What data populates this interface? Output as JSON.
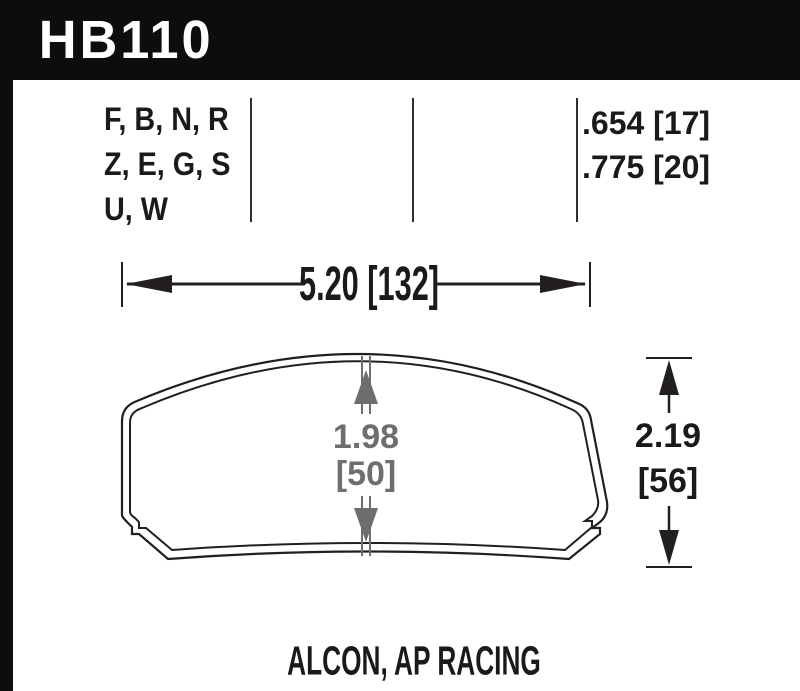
{
  "header": {
    "part_number": "HB110",
    "bg_color": "#0d0d0d",
    "text_color": "#ffffff"
  },
  "spec_table": {
    "compound_rows": [
      "F, B, N, R",
      "Z, E, G, S",
      "U, W"
    ],
    "pad_thickness_rows": [
      ".654 [17]",
      ".775 [20]"
    ]
  },
  "dimensions": {
    "width": {
      "label": "5.20 [132]"
    },
    "height": {
      "line1": "2.19",
      "line2": "[56]"
    },
    "center_thickness": {
      "line1": "1.98",
      "line2": "[50]",
      "color": "#6e6e6e"
    }
  },
  "caption": {
    "applications": "ALCON, AP RACING"
  },
  "colors": {
    "line": "#231f20",
    "accent_gray": "#6e6e6e"
  }
}
